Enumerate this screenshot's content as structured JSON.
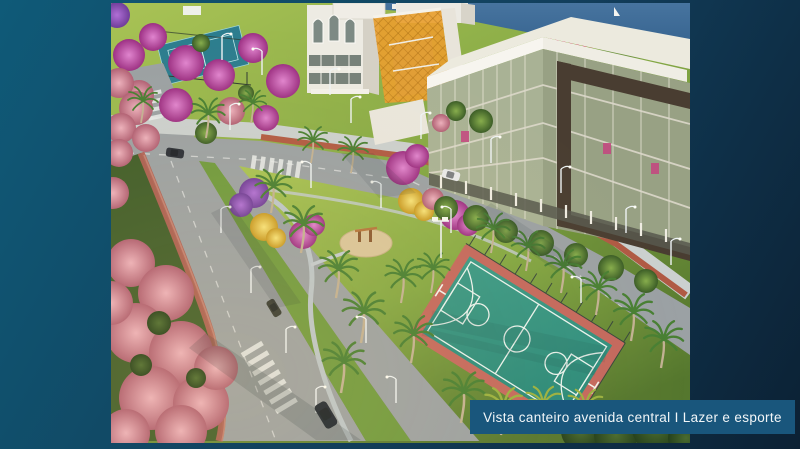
{
  "slide": {
    "caption": {
      "text": "Vista canteiro avenida central I Lazer e esporte",
      "bar_color": "#19567C",
      "text_color": "#F2F6F8"
    },
    "background": {
      "top_left": "#0F5A78",
      "middle": "#123F5C",
      "bottom_right": "#0C2134"
    },
    "image": {
      "alt": "Aerial 3D render of a landscaped central avenue median with leisure and sports areas: basketball court, playground, palm trees, flowering trees, lake, and office buildings",
      "features": [
        "lake with small sailboat",
        "white office building with arched windows",
        "building wing with orange lattice facade",
        "large glass office building with white flat roof and dark brown frame",
        "central avenue with landscaped median",
        "teal basketball court with salmon surround",
        "tennis court behind fence",
        "circular playground",
        "palm trees and flowering trees in magenta, pink and yellow",
        "pedestrian paths, crosswalks, red bike lane",
        "street lamps and cars"
      ],
      "palette": {
        "grass": "#7ca23e",
        "road_gray": "#9ba1a4",
        "sidewalk": "#cbd0cf",
        "bike_lane_red": "#b05a44",
        "median_grass": "#6f9a3f",
        "court_teal": "#2f9180",
        "court_border": "#c4685e",
        "playground_sand": "#d9c69b",
        "building_white": "#edebe3",
        "facade_orange": "#e89e2f",
        "glass_light": "#a9b295",
        "glass_dark": "#98a184",
        "frame_brown": "#493d31",
        "lake_blue": "#3c6b95",
        "flower_magenta": "#c4509e",
        "flower_pink": "#cd8693",
        "flower_yellow": "#e8c93f",
        "paved_edge_pink": "#b06055"
      }
    }
  }
}
